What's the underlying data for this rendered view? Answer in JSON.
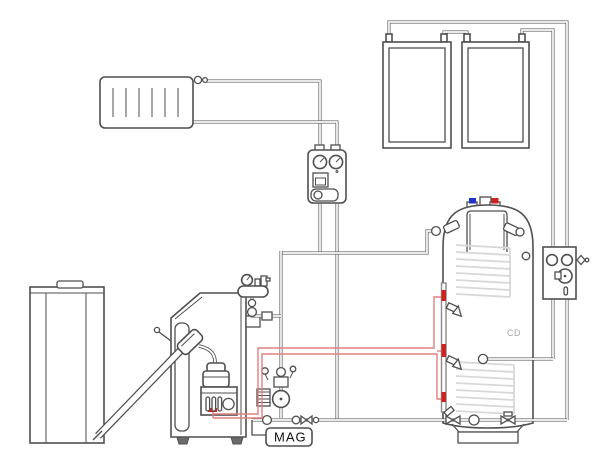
{
  "diagram": {
    "type": "hydraulic-heating-schematic",
    "labels": {
      "expansion_vessel": "MAG",
      "tank_brand": "CD"
    },
    "colors": {
      "line": "#4f4f4f",
      "coil": "#d8d8d8",
      "hot_pipe": "#e08080",
      "cap_red": "#cc2222",
      "cap_blue": "#2233cc",
      "background": "#ffffff"
    },
    "components": [
      {
        "name": "radiator"
      },
      {
        "name": "heating-pump-station"
      },
      {
        "name": "solar-collector-1"
      },
      {
        "name": "solar-collector-2"
      },
      {
        "name": "solar-pump-station"
      },
      {
        "name": "pellet-hopper"
      },
      {
        "name": "auger-feed-tube"
      },
      {
        "name": "pellet-boiler"
      },
      {
        "name": "pellet-burner"
      },
      {
        "name": "boiler-safety-group"
      },
      {
        "name": "boiler-pump-group"
      },
      {
        "name": "expansion-vessel"
      },
      {
        "name": "buffer-tank"
      },
      {
        "name": "upper-heat-exchanger-coil"
      },
      {
        "name": "lower-heat-exchanger-coil"
      }
    ]
  }
}
